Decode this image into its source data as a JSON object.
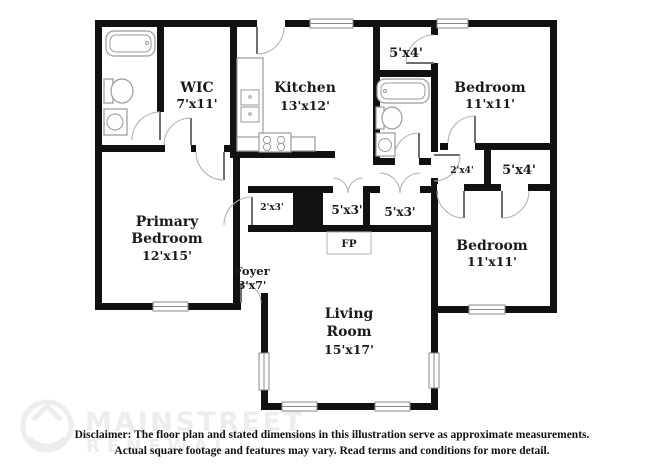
{
  "colors": {
    "wall": "#111111",
    "fixture": "#9a9a9a",
    "winline": "#8a8a8a",
    "door": "#b3b3b3",
    "label": "#1a1a1a",
    "watermark": "#ededed",
    "disclaimer": "#111111"
  },
  "rooms": {
    "wic": {
      "name": "WIC",
      "dims": "7'x11'"
    },
    "kitchen": {
      "name": "Kitchen",
      "dims": "13'x12'"
    },
    "bedroom_top_right": {
      "name": "Bedroom",
      "dims": "11'x11'"
    },
    "bedroom_bottom_right": {
      "name": "Bedroom",
      "dims": "11'x11'"
    },
    "primary_bedroom": {
      "name_line1": "Primary",
      "name_line2": "Bedroom",
      "dims": "12'x15'"
    },
    "living_room": {
      "name_line1": "Living",
      "name_line2": "Room",
      "dims": "15'x17'"
    },
    "foyer": {
      "name": "Foyer",
      "dims": "3'x7'"
    }
  },
  "closets": {
    "top_middle": "5'x4'",
    "right_small": "2'x4'",
    "right_large": "5'x4'",
    "hall_small": "2'x3'",
    "hall_left": "5'x3'",
    "hall_right": "5'x3'"
  },
  "fireplace_label": "FP",
  "watermark": {
    "line1": "MAINSTREET",
    "line2": "RENEWAL"
  },
  "disclaimer": {
    "line1": "Disclaimer: The floor plan and stated dimensions in this illustration serve as approximate measurements.",
    "line2": "Actual square footage and features may vary. Read terms and conditions for more detail."
  }
}
